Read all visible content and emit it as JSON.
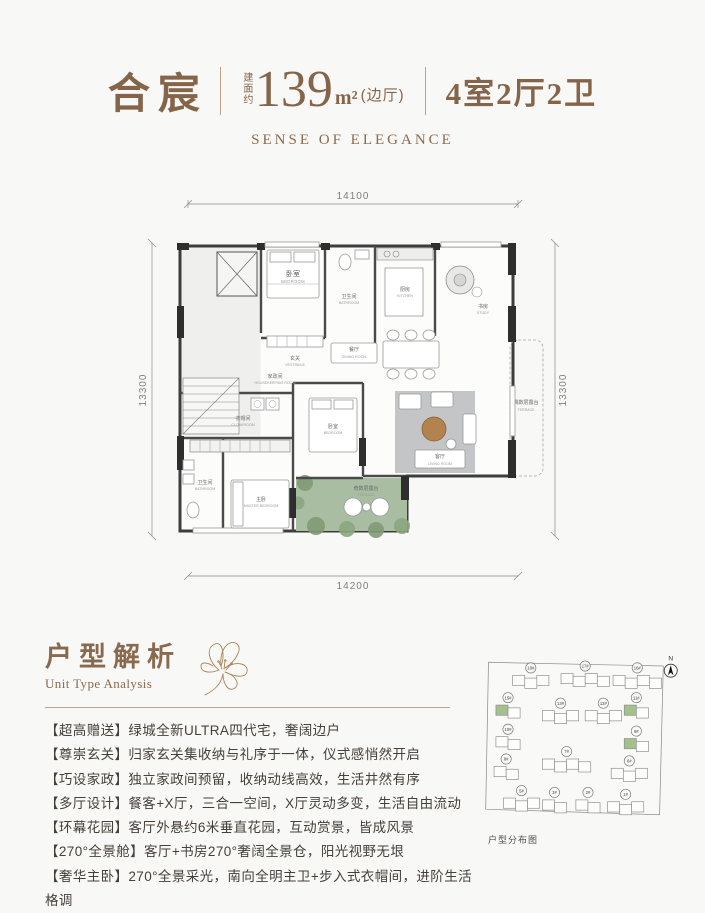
{
  "colors": {
    "accent": "#85654a",
    "terrace_green": "#a9bda2",
    "tree_green": "#7e9a74",
    "highlight_green": "#a4c18b",
    "wall": "#3d3d3d",
    "wood_table": "#b2834e"
  },
  "header": {
    "brand": "合宸",
    "area_prefix": "建面约",
    "area_value": "139",
    "area_unit": "m²",
    "area_note": "(边厅)",
    "spec": "4室2厅2卫",
    "subtitle": "SENSE OF ELEGANCE"
  },
  "plan": {
    "dims": {
      "top": "14100",
      "bottom": "14200",
      "left": "13300",
      "right": "13300"
    },
    "rooms": {
      "bedroom_top": {
        "cn": "卧室",
        "en": "BEDROOM"
      },
      "bathroom_top": {
        "cn": "卫生间",
        "en": "BATHROOM"
      },
      "kitchen": {
        "cn": "厨房",
        "en": "KITCHEN"
      },
      "study": {
        "cn": "书房",
        "en": "STUDY"
      },
      "vestibule": {
        "cn": "玄关",
        "en": "VESTIBULE"
      },
      "dining": {
        "cn": "餐厅",
        "en": "DINING ROOM"
      },
      "housekeeping": {
        "cn": "家政间",
        "en": "HOUSEKEEPING ROOM"
      },
      "cloakroom": {
        "cn": "衣帽间",
        "en": "CLOAKROOM"
      },
      "master_bath": {
        "cn": "卫生间",
        "en": "BATHROOM"
      },
      "master_bedroom": {
        "cn": "主卧",
        "en": "MASTER BEDROOM"
      },
      "bedroom_south": {
        "cn": "卧室",
        "en": "BEDROOM"
      },
      "living": {
        "cn": "客厅",
        "en": "LIVING ROOM"
      },
      "terrace_odd": {
        "cn": "奇数层露台",
        "en": "TERRACE"
      },
      "terrace_even": {
        "cn": "偶数层露台",
        "en": "TERRACE"
      }
    }
  },
  "analysis": {
    "title_cn": "户型解析",
    "title_en": "Unit Type Analysis",
    "bullets": [
      "【超高赠送】绿城全新ULTRA四代宅，奢阔边户",
      "【尊崇玄关】归家玄关集收纳与礼序于一体，仪式感悄然开启",
      "【巧设家政】独立家政间预留，收纳动线高效，生活井然有序",
      "【多厅设计】餐客+X厅，三合一空间，X厅灵动多变，生活自由流动",
      "【环幕花园】客厅外悬约6米垂直花园，互动赏景，皆成风景",
      "【270°全景舱】客厅+书房270°奢阔全景仓，阳光视野无垠",
      "【奢华主卧】270°全景采光，南向全明主卫+步入式衣帽间，进阶生活格调"
    ]
  },
  "siteplan": {
    "caption": "户型分布图",
    "north_label": "N",
    "buildings": [
      {
        "label": "18#",
        "green": false
      },
      {
        "label": "17#",
        "green": false
      },
      {
        "label": "16#",
        "green": false
      },
      {
        "label": "15#",
        "green": true
      },
      {
        "label": "13#",
        "green": false
      },
      {
        "label": "12#",
        "green": false
      },
      {
        "label": "11#",
        "green": true
      },
      {
        "label": "10#",
        "green": false
      },
      {
        "label": "9#",
        "green": true
      },
      {
        "label": "8#",
        "green": false
      },
      {
        "label": "7#",
        "green": false
      },
      {
        "label": "6#",
        "green": false
      },
      {
        "label": "5#",
        "green": false
      },
      {
        "label": "3#",
        "green": false
      },
      {
        "label": "2#",
        "green": false
      },
      {
        "label": "1#",
        "green": false
      }
    ]
  }
}
